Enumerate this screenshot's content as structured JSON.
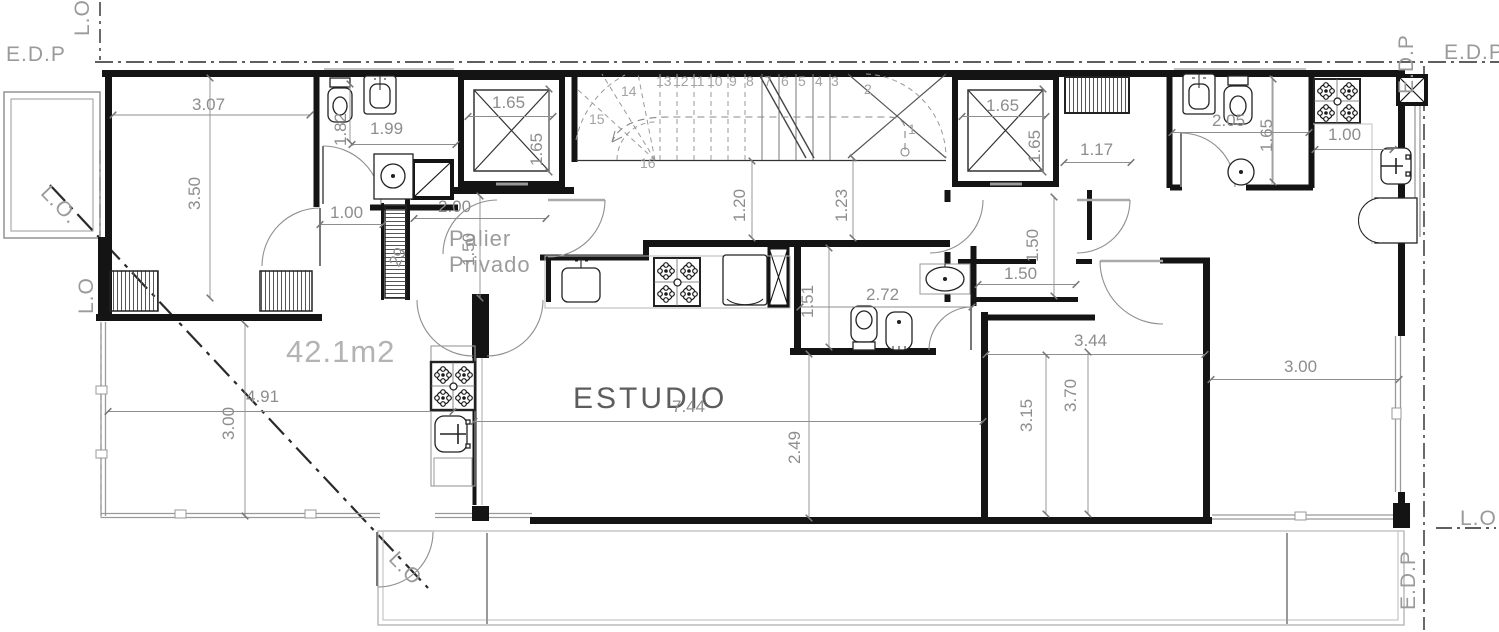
{
  "boundary": {
    "lo": "L.O",
    "lo_dot": "L.O.",
    "edp": "E.D.P"
  },
  "rooms": {
    "estudio": "ESTUDIO",
    "palier_line1": "Palier",
    "palier_line2": "Privado",
    "area": "42.1m2"
  },
  "dims": {
    "bedroom_w": "3.07",
    "bedroom_d": "3.50",
    "bath1_d": "1.82",
    "bath1_w": "1.99",
    "lift_left_w": "1.65",
    "lift_left_d": "1.65",
    "bedroom_door": "1.00",
    "palier_w": "2.00",
    "palier_d": "1.50",
    "duct": "29",
    "hall_left": "1.20",
    "hall_right": "1.23",
    "lift_right_w": "1.65",
    "lift_right_d": "1.65",
    "hall2_w": "1.17",
    "bath3_w": "2.05",
    "bath3_d": "1.65",
    "kitchen_right": "1.00",
    "palier2_d": "1.50",
    "palier2_w": "1.50",
    "bath2_d": "1.51",
    "bath2_w": "2.72",
    "estudio_w": "7.44",
    "estudio_d": "2.49",
    "terrace_w": "4.91",
    "terrace_d": "3.00",
    "bedroom2_w": "3.44",
    "bedroom2_d": "3.70",
    "bedroom2_d2": "3.15",
    "balcony_w": "3.00"
  },
  "stairs": {
    "steps": [
      "1",
      "2",
      "3",
      "4",
      "5",
      "6",
      "7",
      "8",
      "9",
      "10",
      "11",
      "12",
      "13",
      "14",
      "15",
      "16"
    ]
  }
}
